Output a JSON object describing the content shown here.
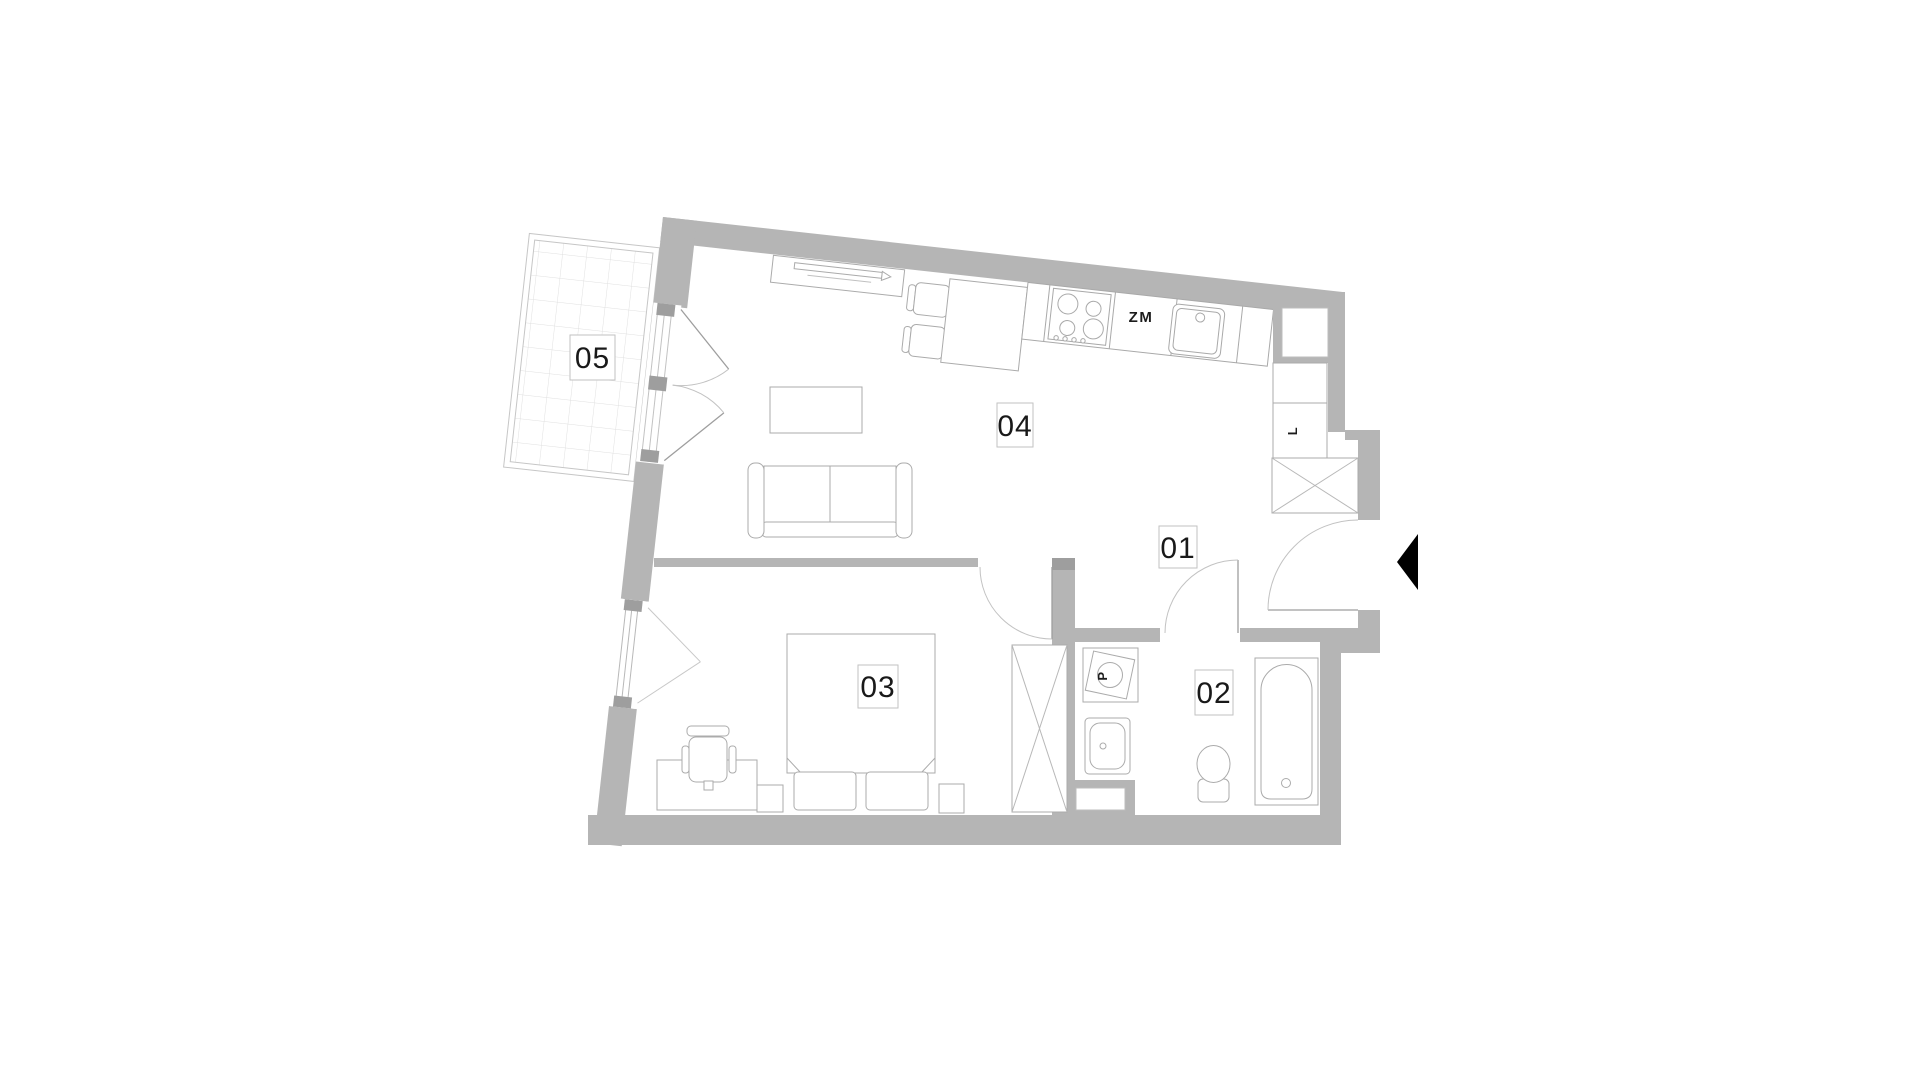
{
  "plan": {
    "title": "apartment-floor-plan",
    "rooms": [
      {
        "number": "01",
        "name": "hall"
      },
      {
        "number": "02",
        "name": "bathroom"
      },
      {
        "number": "03",
        "name": "bedroom"
      },
      {
        "number": "04",
        "name": "living-room-with-kitchen"
      },
      {
        "number": "05",
        "name": "balcony"
      }
    ],
    "appliances": {
      "dishwasher": "ZM",
      "fridge": "L",
      "washing_machine": "P"
    },
    "icons": {
      "entrance-arrow": "left-pointing-black-triangle"
    },
    "colors": {
      "wall": "#b5b5b5",
      "wall_dark": "#9e9e9e",
      "furniture_line": "#ababab",
      "grid_line": "#e0e0e0",
      "label_text": "#191919",
      "entrance_marker": "#000000"
    }
  }
}
